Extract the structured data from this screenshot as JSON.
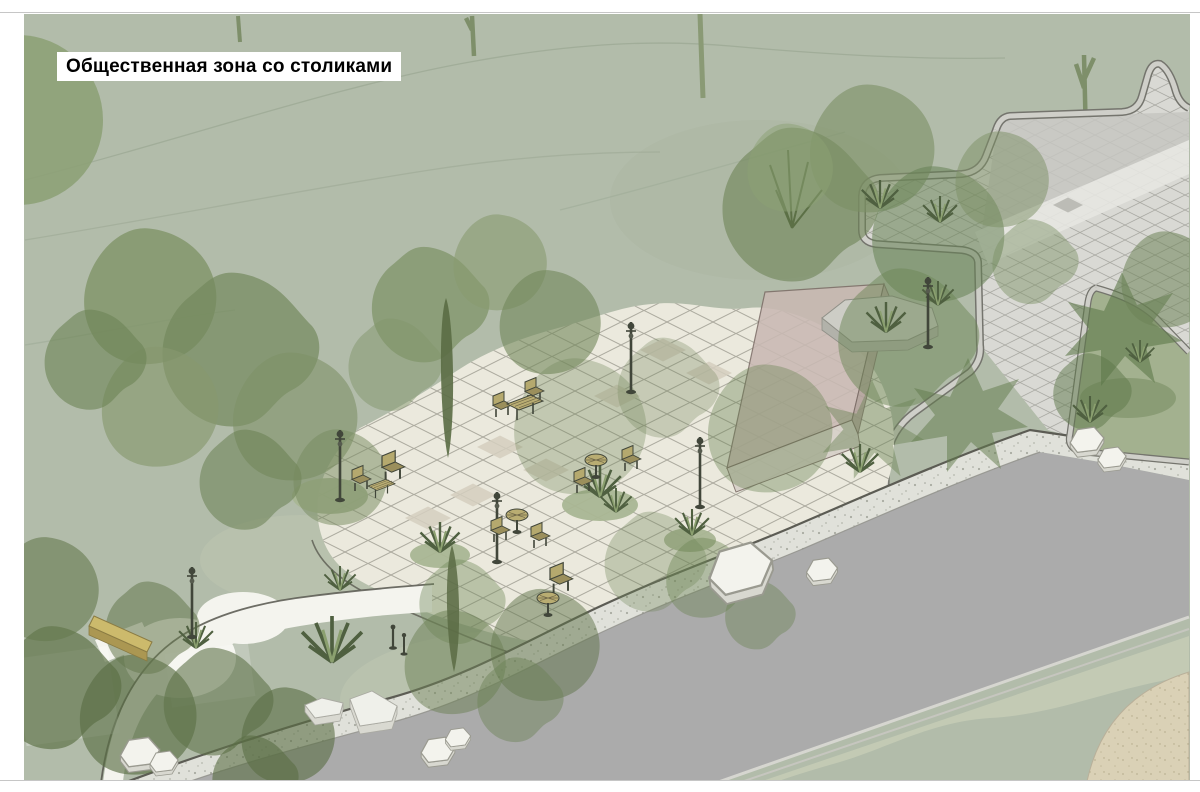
{
  "title": {
    "text": "Общественная зона со столиками",
    "color": "#8b1818",
    "background": "#ffffff"
  },
  "palette": {
    "page_background": "#ffffff",
    "frame_line": "#c6c6c6",
    "grass": "#b2bcaa",
    "grass_light": "#c0c8b2",
    "contour_line": "#9fab97",
    "tree_dark": "#5f7349",
    "tree_mid": "#7b9164",
    "tree_light": "#8da177",
    "plaza_cream": "#ebe9dd",
    "plaza_tile_line": "#97958a",
    "plaza_tile_dark": "#d5cfbf",
    "gray_plaza": "#d9d9d4",
    "gray_plaza_dark": "#c6c6c1",
    "curb_light": "#cfcfc9",
    "curb_dark": "#74746d",
    "road": "#ababab",
    "sidewalk": "#e0e1da",
    "building_top": "#c9b9b3",
    "building_front": "#d7d0c8",
    "building_side": "#b2a19b",
    "bench_yellow": "#ccba6c",
    "stone_white": "#f3f3ed",
    "sand": "#dad1b6",
    "furniture_dark": "#41463a",
    "furniture_tan": "#b5a96e"
  },
  "scene": {
    "type": "landscape-plan-axonometric-render",
    "features": [
      "grass",
      "contour lines",
      "paved plaza with diamond tiles",
      "gray tiled square",
      "road",
      "speckled sidewalk",
      "pavilion",
      "concrete planter",
      "picnic tables",
      "chairs",
      "round tables",
      "yellow bench",
      "street lamps",
      "bollards",
      "white stones",
      "trees",
      "shrub tufts",
      "sand area"
    ]
  }
}
